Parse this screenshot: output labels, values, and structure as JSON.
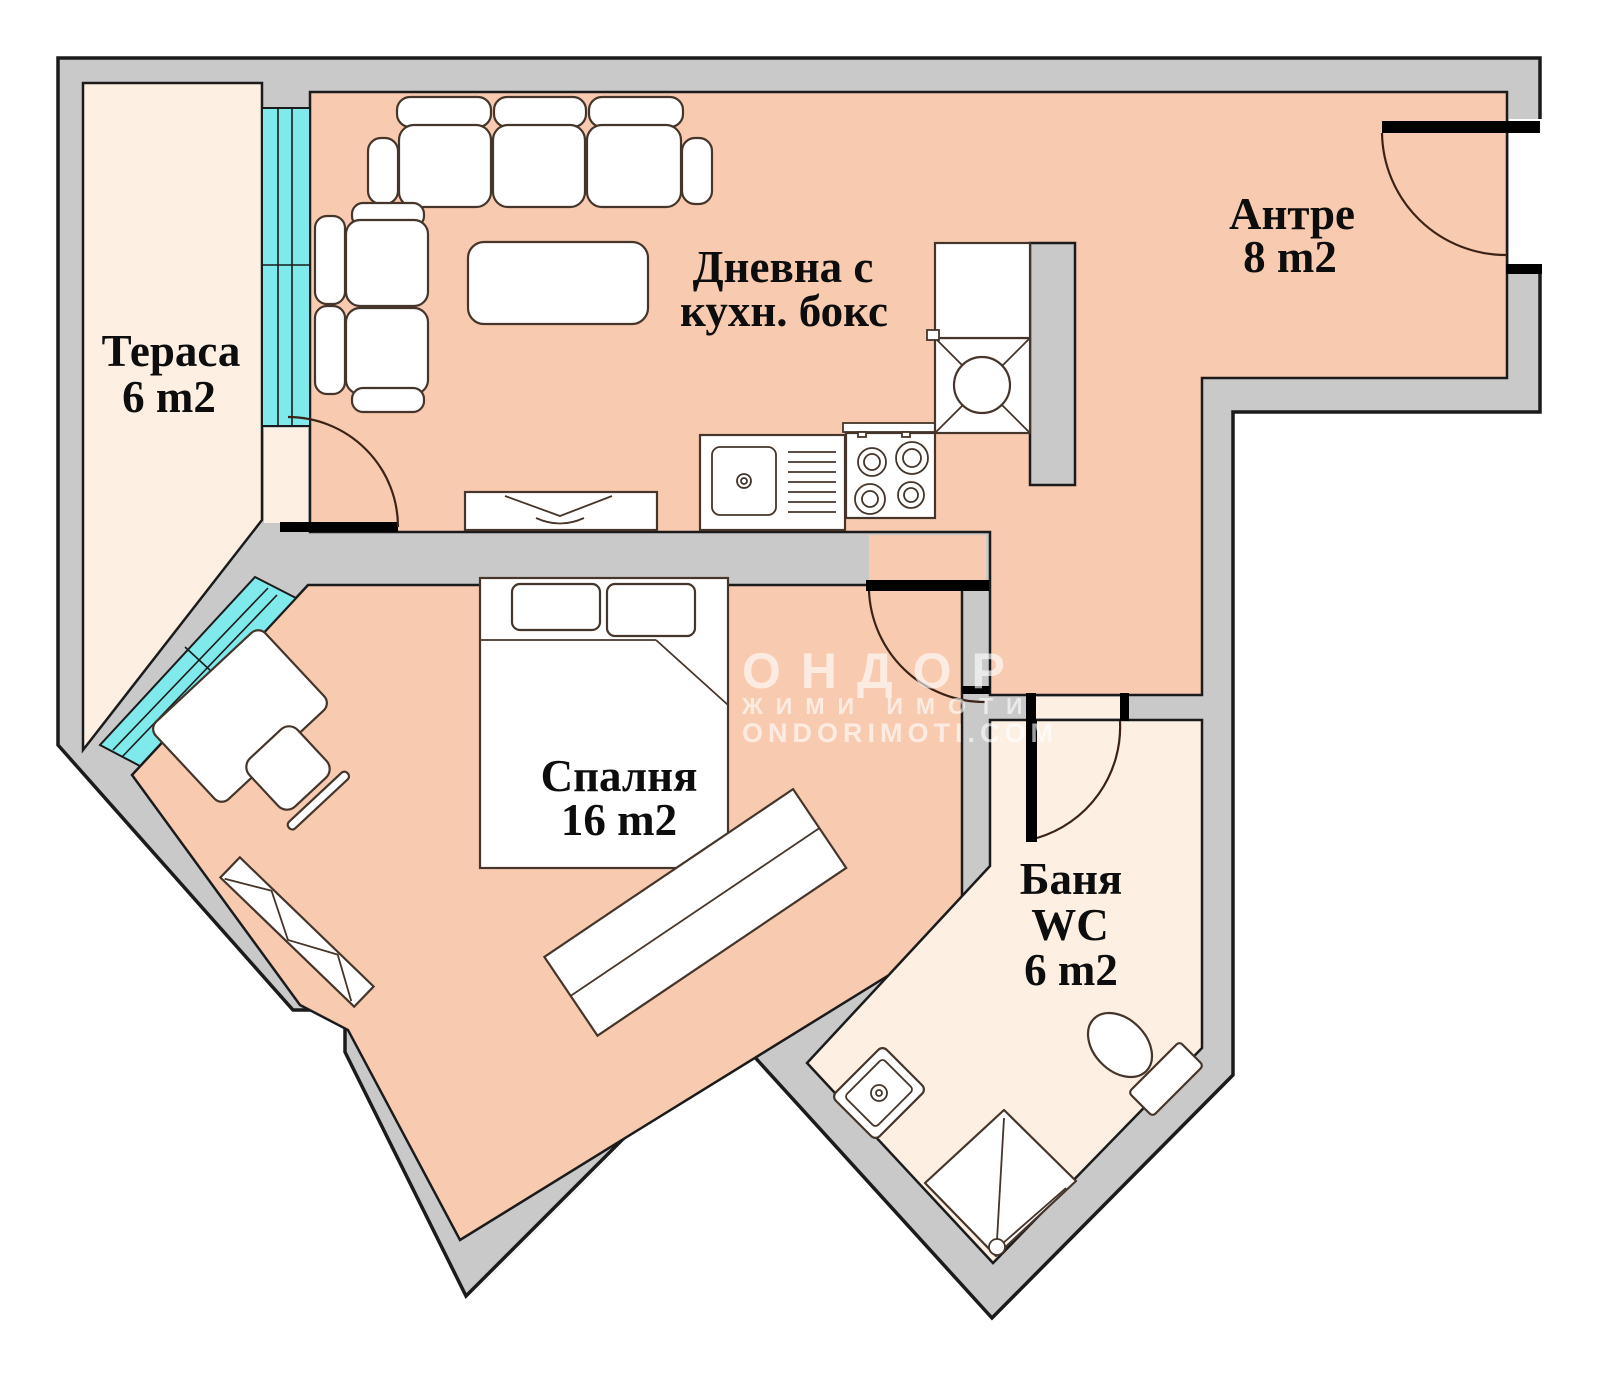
{
  "plan": {
    "title": "apartment-floor-plan",
    "rooms": {
      "terrace": {
        "name": "Тераса",
        "area": "6 m2"
      },
      "living": {
        "name_line1": "Дневна с",
        "name_line2": "кухн. бокс"
      },
      "hall": {
        "name": "Антре",
        "area": "8 m2"
      },
      "bedroom": {
        "name": "Спалня",
        "area": "16 m2"
      },
      "bath": {
        "name_line1": "Баня",
        "name_line2": "WC",
        "area": "6 m2"
      }
    },
    "watermark": {
      "line1": "ОНДОР",
      "line2": "ЖИМИ ИМОТИ",
      "line3": "ONDORIMOTI.COM"
    },
    "colors": {
      "wall": "#c9c9c9",
      "floor-main": "#f8cbb1",
      "floor-light": "#fdf0e2",
      "window": "#7fe9ec"
    }
  }
}
